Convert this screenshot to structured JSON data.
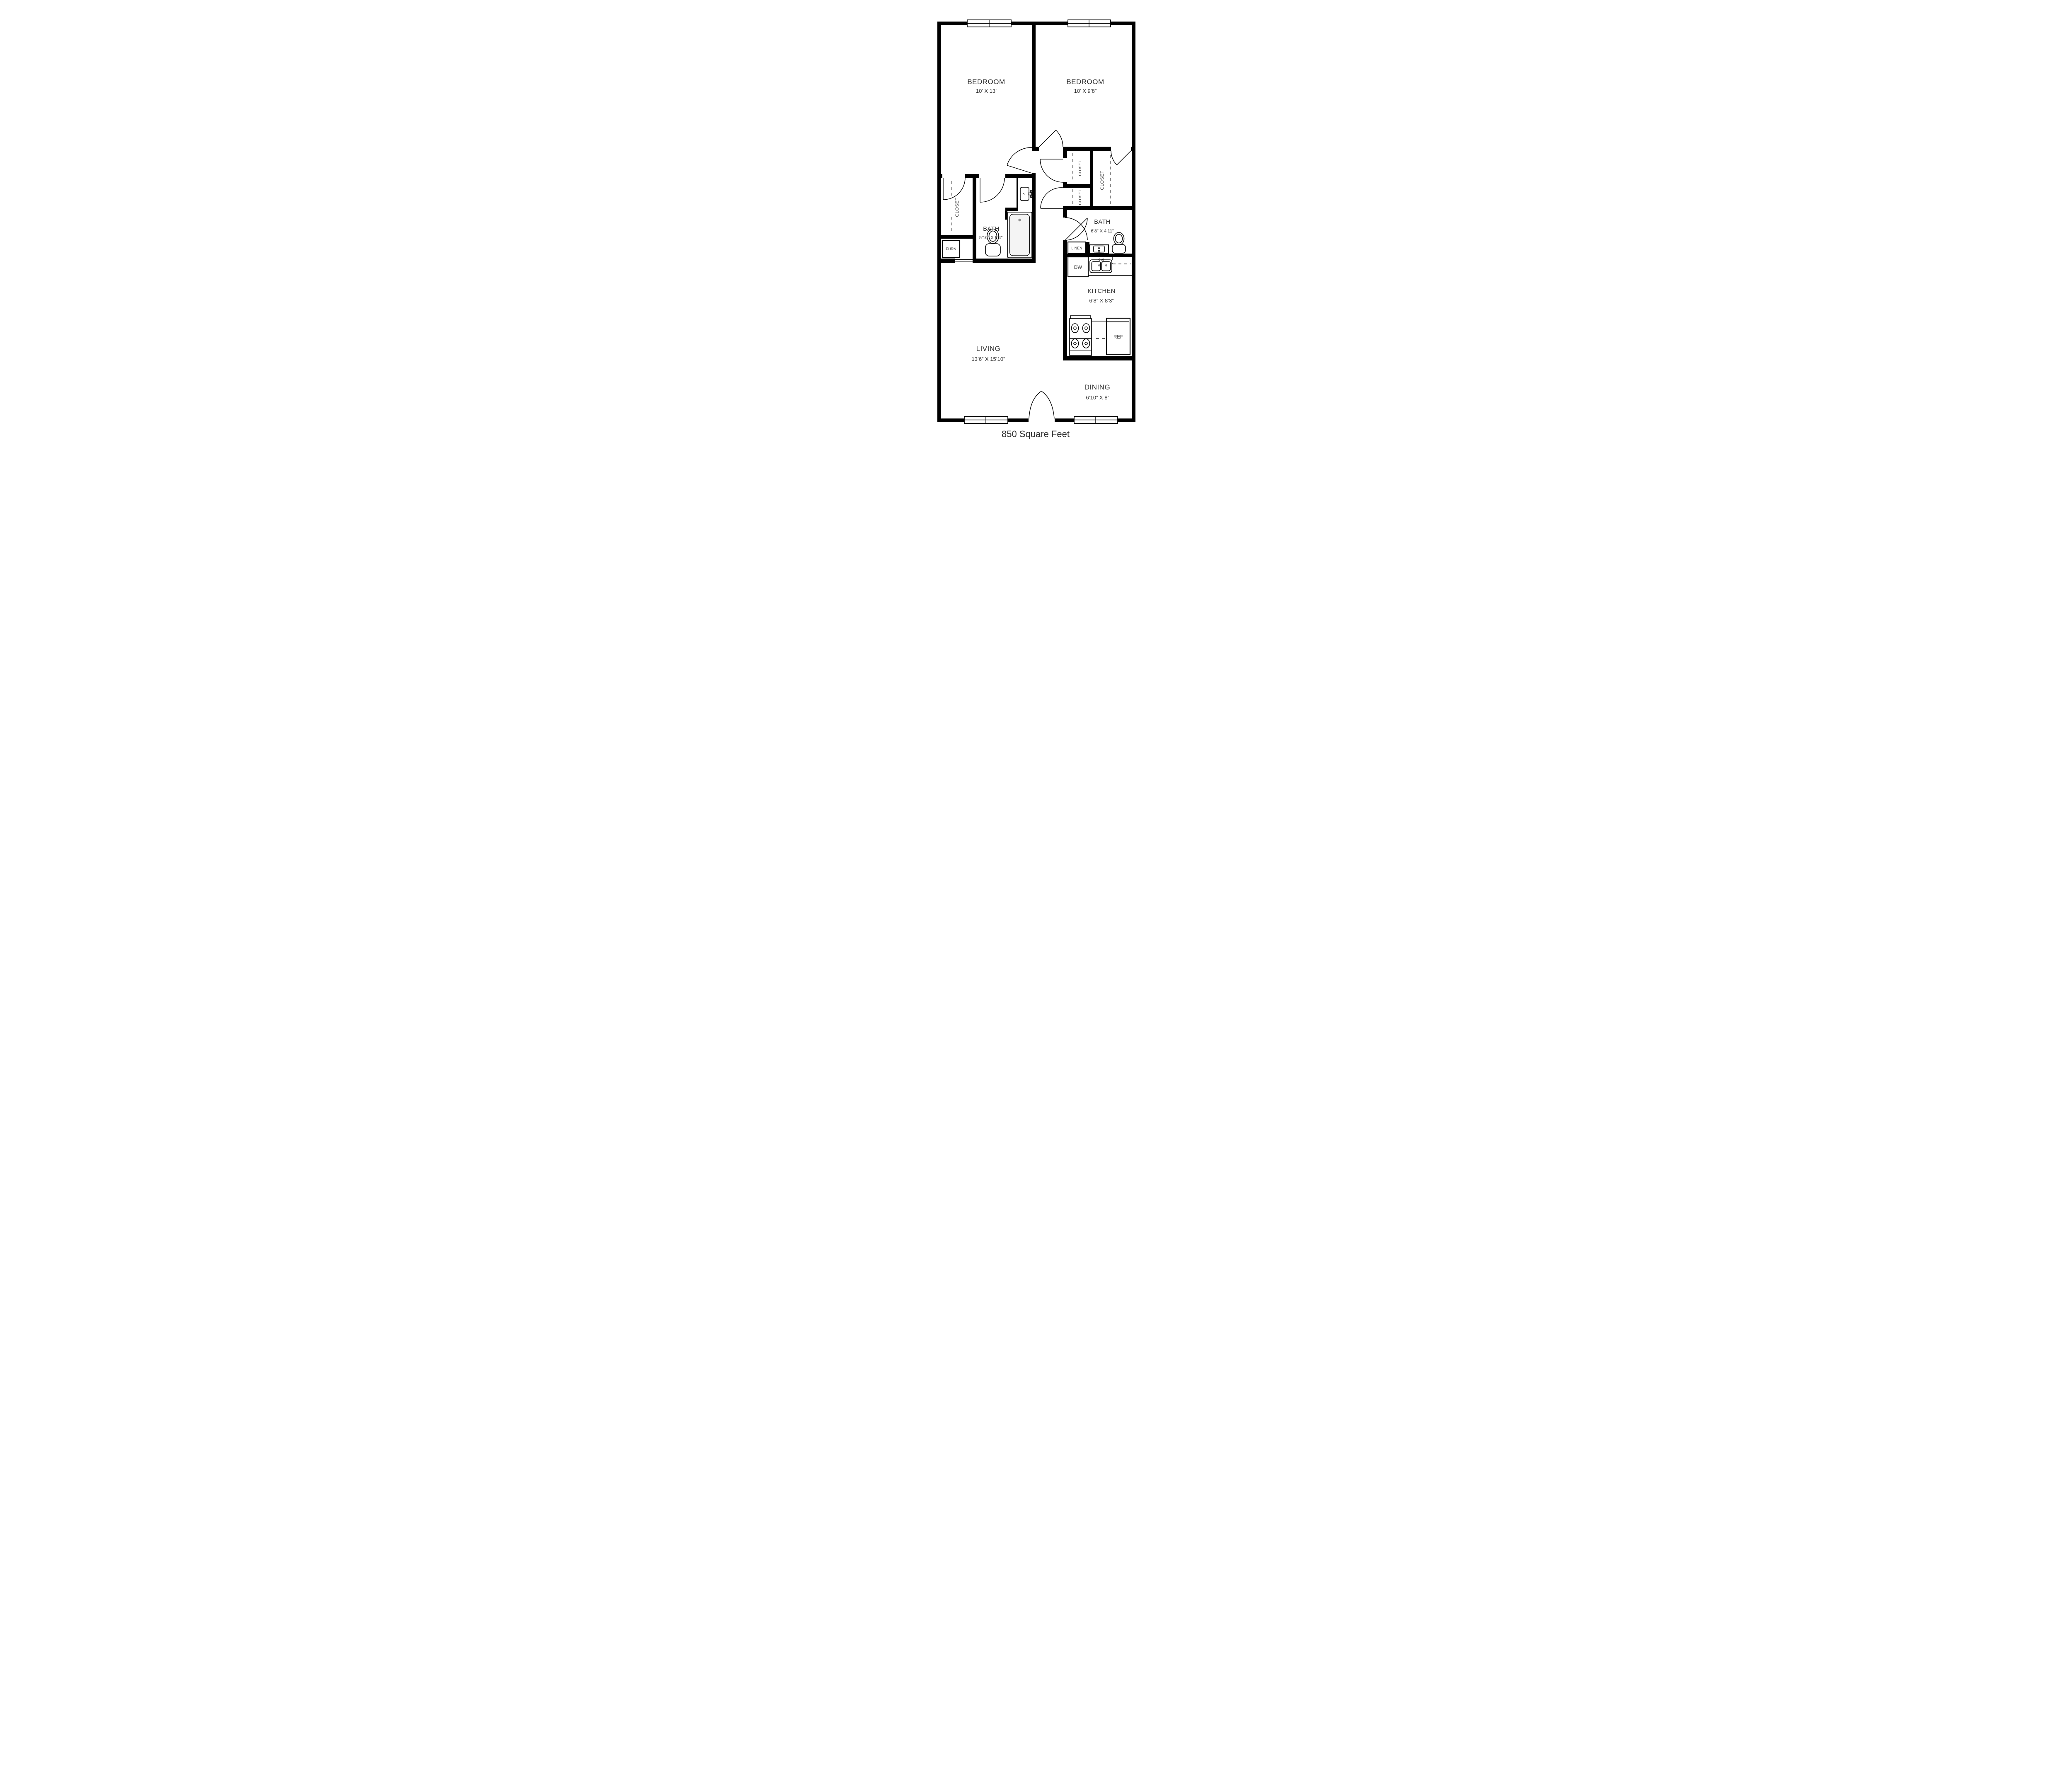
{
  "floor_plan": {
    "total_area": "850 Square Feet",
    "rooms": {
      "bedroom1": {
        "name": "BEDROOM",
        "dims": "10’ X 13’"
      },
      "bedroom2": {
        "name": "BEDROOM",
        "dims": "10’ X 9’8”"
      },
      "bath1": {
        "name": "BATH",
        "dims": "5’10” X 8’4”"
      },
      "bath2": {
        "name": "BATH",
        "dims": "6’8” X 4’11”"
      },
      "kitchen": {
        "name": "KITCHEN",
        "dims": "6’8” X 8’3”"
      },
      "living": {
        "name": "LIVING",
        "dims": "13’6” X 15’10”"
      },
      "dining": {
        "name": "DINING",
        "dims": "6’10” X 8’"
      },
      "closet_bedroom1": {
        "name": "CLOSET"
      },
      "closet_hall_top": {
        "name": "CLOSET"
      },
      "closet_hall_bottom": {
        "name": "CLOSET"
      },
      "closet_bedroom2": {
        "name": "CLOSET"
      }
    },
    "labels": {
      "furnace": "FURN",
      "linen": "LINEN",
      "dishwasher": "DW",
      "refrigerator": "REF"
    },
    "colors": {
      "walls": "#000000",
      "text": "#2f2f2f",
      "background": "#ffffff"
    }
  }
}
